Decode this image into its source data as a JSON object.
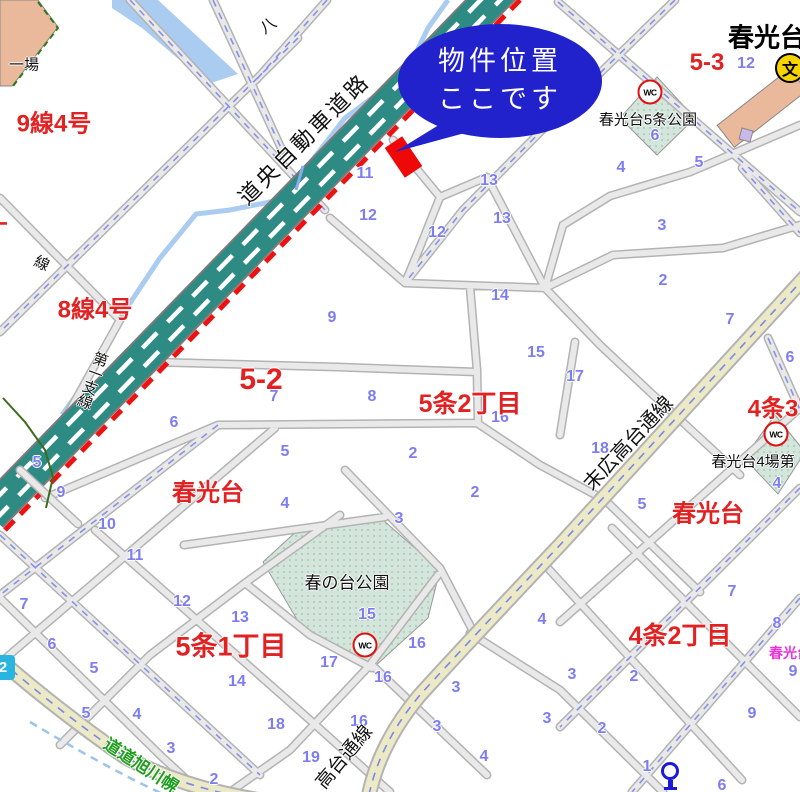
{
  "callout": {
    "line1": "物件位置",
    "line2": "ここです"
  },
  "map": {
    "labels": [
      {
        "t": "9線4号",
        "x": 54,
        "y": 121,
        "s": 24,
        "k": "red"
      },
      {
        "t": "8線4号",
        "x": 95,
        "y": 307,
        "s": 24,
        "k": "red"
      },
      {
        "t": "丁",
        "x": -4,
        "y": 230,
        "s": 24,
        "k": "red"
      },
      {
        "t": "5-2",
        "x": 261,
        "y": 380,
        "s": 30,
        "k": "red"
      },
      {
        "t": "5条2丁目",
        "x": 470,
        "y": 402,
        "s": 25,
        "k": "red"
      },
      {
        "t": "4条3丁目",
        "x": 797,
        "y": 406,
        "s": 24,
        "k": "red"
      },
      {
        "t": "春光台",
        "x": 208,
        "y": 490,
        "s": 24,
        "k": "red"
      },
      {
        "t": "春光台",
        "x": 708,
        "y": 511,
        "s": 24,
        "k": "red"
      },
      {
        "t": "5条1丁目",
        "x": 231,
        "y": 644,
        "s": 27,
        "k": "red"
      },
      {
        "t": "4条2丁目",
        "x": 680,
        "y": 634,
        "s": 25,
        "k": "red"
      },
      {
        "t": "5-3",
        "x": 707,
        "y": 63,
        "s": 24,
        "k": "red"
      },
      {
        "t": "春光台",
        "x": 767,
        "y": 36,
        "s": 26,
        "k": "black-bold"
      },
      {
        "t": "春光台5条公園",
        "x": 648,
        "y": 119,
        "s": 15,
        "k": "black"
      },
      {
        "t": "春の台公園",
        "x": 347,
        "y": 581,
        "s": 17,
        "k": "black"
      },
      {
        "t": "春光台4場第",
        "x": 753,
        "y": 461,
        "s": 15,
        "k": "black"
      },
      {
        "t": "一場",
        "x": 24,
        "y": 64,
        "s": 15,
        "k": "black"
      },
      {
        "t": "八",
        "x": 267,
        "y": 24,
        "s": 16,
        "k": "black",
        "rot": -35
      },
      {
        "t": "春光台",
        "x": 790,
        "y": 653,
        "s": 14,
        "k": "magenta"
      },
      {
        "t": "道央自動車道路",
        "x": 303,
        "y": 138,
        "s": 22,
        "k": "black",
        "rot": -45,
        "ls": 3
      },
      {
        "t": "末広高台通線",
        "x": 627,
        "y": 442,
        "s": 20,
        "k": "black",
        "rot": -47
      },
      {
        "t": "高台通線",
        "x": 343,
        "y": 756,
        "s": 19,
        "k": "black",
        "rot": -50
      },
      {
        "t": "道道旭川幌",
        "x": 142,
        "y": 764,
        "s": 17,
        "k": "green",
        "rot": 33
      },
      {
        "t": "第一支線",
        "x": 92,
        "y": 380,
        "s": 15,
        "k": "black",
        "rot": 20,
        "vert": true
      },
      {
        "t": "線",
        "x": 42,
        "y": 263,
        "s": 15,
        "k": "black",
        "rot": 25
      }
    ],
    "blue_numbers": [
      [
        365,
        174,
        "11"
      ],
      [
        368,
        216,
        "12"
      ],
      [
        437,
        233,
        "12"
      ],
      [
        489,
        181,
        "13"
      ],
      [
        502,
        219,
        "13"
      ],
      [
        500,
        296,
        "14"
      ],
      [
        536,
        353,
        "15"
      ],
      [
        500,
        418,
        "16"
      ],
      [
        332,
        318,
        "9"
      ],
      [
        274,
        397,
        "7"
      ],
      [
        372,
        397,
        "8"
      ],
      [
        285,
        452,
        "5"
      ],
      [
        413,
        454,
        "2"
      ],
      [
        746,
        64,
        "12"
      ],
      [
        655,
        136,
        "6"
      ],
      [
        621,
        168,
        "4"
      ],
      [
        699,
        163,
        "5"
      ],
      [
        662,
        226,
        "3"
      ],
      [
        663,
        281,
        "2"
      ],
      [
        730,
        320,
        "7"
      ],
      [
        790,
        358,
        "6"
      ],
      [
        575,
        377,
        "17"
      ],
      [
        600,
        449,
        "18"
      ],
      [
        642,
        505,
        "5"
      ],
      [
        777,
        484,
        "4"
      ],
      [
        475,
        493,
        "2"
      ],
      [
        285,
        504,
        "4"
      ],
      [
        399,
        519,
        "3"
      ],
      [
        182,
        602,
        "12"
      ],
      [
        240,
        618,
        "13"
      ],
      [
        367,
        615,
        "15"
      ],
      [
        417,
        644,
        "16"
      ],
      [
        329,
        663,
        "17"
      ],
      [
        237,
        682,
        "14"
      ],
      [
        383,
        678,
        "16"
      ],
      [
        359,
        722,
        "16"
      ],
      [
        276,
        725,
        "18"
      ],
      [
        311,
        758,
        "19"
      ],
      [
        456,
        688,
        "3"
      ],
      [
        437,
        727,
        "3"
      ],
      [
        547,
        719,
        "3"
      ],
      [
        484,
        757,
        "4"
      ],
      [
        542,
        620,
        "4"
      ],
      [
        174,
        423,
        "6"
      ],
      [
        61,
        493,
        "9"
      ],
      [
        107,
        525,
        "10"
      ],
      [
        135,
        556,
        "11"
      ],
      [
        37,
        463,
        "5"
      ],
      [
        24,
        605,
        "7"
      ],
      [
        52,
        645,
        "6"
      ],
      [
        94,
        669,
        "5"
      ],
      [
        86,
        714,
        "5"
      ],
      [
        137,
        715,
        "4"
      ],
      [
        171,
        749,
        "3"
      ],
      [
        214,
        780,
        "2"
      ],
      [
        732,
        592,
        "7"
      ],
      [
        777,
        624,
        "8"
      ],
      [
        793,
        672,
        "9"
      ],
      [
        572,
        675,
        "3"
      ],
      [
        634,
        677,
        "2"
      ],
      [
        602,
        729,
        "2"
      ],
      [
        752,
        714,
        "9"
      ],
      [
        647,
        767,
        "1"
      ],
      [
        722,
        786,
        "6"
      ]
    ],
    "wc_positions": [
      [
        650,
        92
      ],
      [
        776,
        434
      ],
      [
        365,
        645
      ]
    ],
    "icons": {
      "wc": "WC",
      "school": "文",
      "route": "2"
    }
  },
  "colors": {
    "highway": "#2e8b84",
    "boundary_red": "#ee1111",
    "road_fill": "#e9e9e9",
    "road_casing": "#b3b3b3",
    "main_road_fill": "#ece9c6",
    "water": "#a9ccf0",
    "park": "#d4e6dc",
    "building": "#eab99b",
    "callout": "#2222cc",
    "marker": "#ee0808",
    "number_blue": "#7d7df0",
    "label_red": "#e22222",
    "green_road_text": "#1e9e1e"
  }
}
